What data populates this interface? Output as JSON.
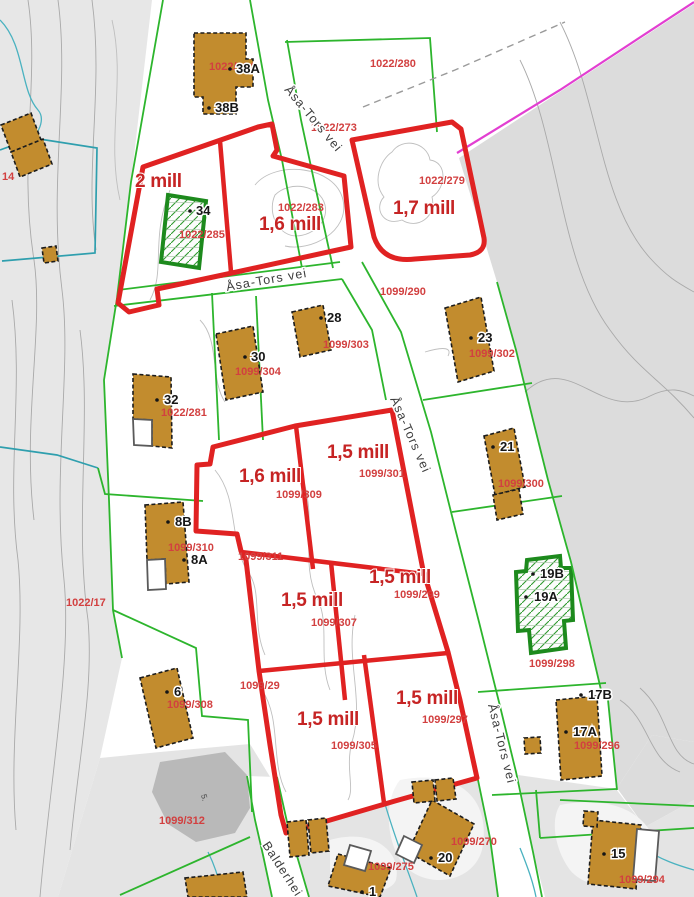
{
  "streets": {
    "asa_tors_vei": "Åsa-Tors vei",
    "balderhei": "Balderhei"
  },
  "prices": [
    "2 mill",
    "1,6 mill",
    "1,7 mill",
    "1,6 mill",
    "1,5 mill",
    "1,5 mill",
    "1,5 mill",
    "1,5 mill",
    "1,5 mill"
  ],
  "parcels": [
    "1022/284",
    "1022/280",
    "1022/273",
    "1022/279",
    "1022/283",
    "1022/285",
    "1099/290",
    "1099/303",
    "1099/304",
    "1022/281",
    "1099/302",
    "1099/301",
    "1099/309",
    "1099/300",
    "1099/310",
    "1099/311",
    "1022/17",
    "1099/299",
    "1099/307",
    "1099/298",
    "1099/29",
    "1099/308",
    "1099/305",
    "1099/297",
    "1099/296",
    "1099/312",
    "1099/270",
    "1099/275",
    "1099/294",
    "14"
  ],
  "houses": [
    "38A",
    "38B",
    "34",
    "28",
    "30",
    "32",
    "23",
    "21",
    "8B",
    "8A",
    "19B",
    "19A",
    "6",
    "17B",
    "17A",
    "20",
    "15",
    "1"
  ],
  "terrain": {
    "spot_marker": "5."
  },
  "colors": {
    "plot_outline_red": "#e02222",
    "price_text_red": "#c62424",
    "parcel_text_red": "#d24040",
    "building_fill_tan": "#c28c2e",
    "boundary_green": "#2db52d",
    "hatch_green": "#1d8a1d",
    "boundary_teal": "#2f9fae",
    "boundary_magenta": "#e23fd1",
    "terrain_gray": "#e7e7e7"
  }
}
